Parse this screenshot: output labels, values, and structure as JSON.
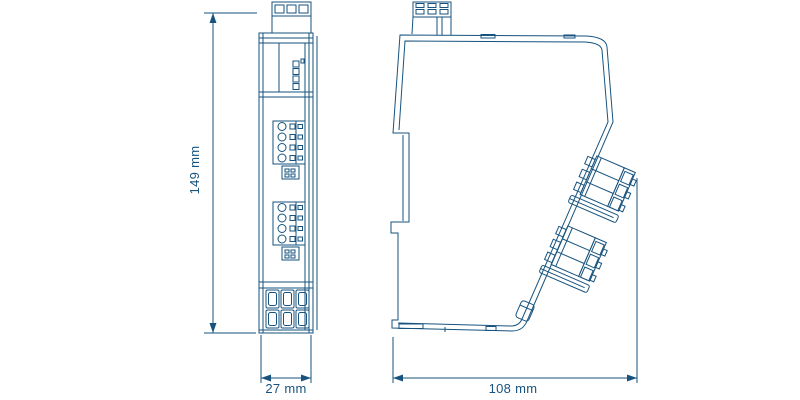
{
  "drawing": {
    "dimensions": {
      "height_label": "149 mm",
      "width_label": "27 mm",
      "depth_label": "108 mm"
    },
    "colors": {
      "line": "#17537E",
      "background": "#FFFFFF"
    }
  }
}
